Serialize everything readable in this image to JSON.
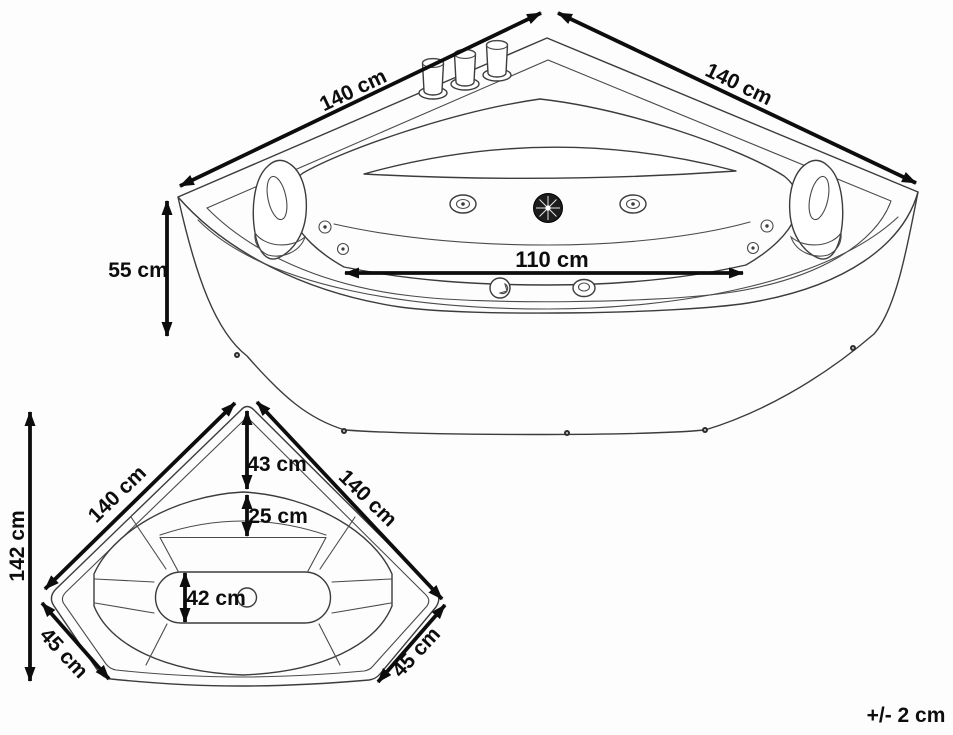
{
  "diagram": {
    "type": "corner-bathtub-dimension-diagram",
    "tolerance_note": "+/- 2 cm",
    "top_view": {
      "edge_left": "140 cm",
      "edge_right": "140 cm",
      "height": "55 cm",
      "inner_width": "110 cm"
    },
    "plan_view": {
      "overall_depth": "142 cm",
      "edge_left": "140 cm",
      "edge_right": "140 cm",
      "corner_to_rim": "43 cm",
      "rim_to_backrest": "25 cm",
      "floor_width": "42 cm",
      "chamfer_left": "45 cm",
      "chamfer_right": "45 cm"
    },
    "colors": {
      "background": "#fdfdfd",
      "line_ink": "#3c3c3c",
      "dimension_ink": "#0d0d0d"
    }
  }
}
